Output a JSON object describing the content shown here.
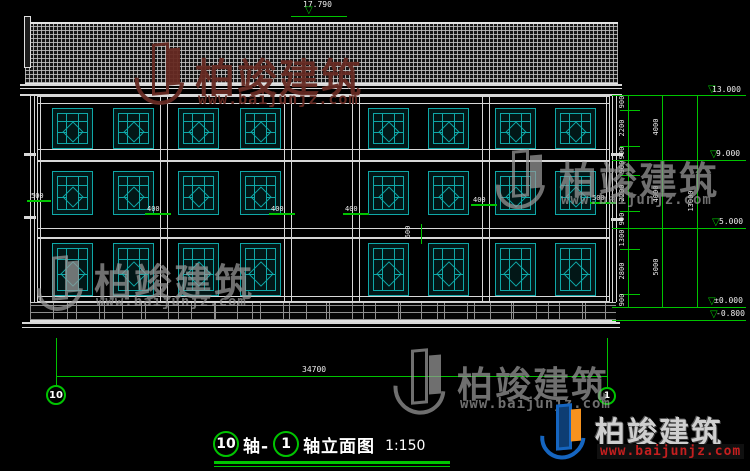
{
  "title_block": {
    "axis_left": "10",
    "joiner": "轴-",
    "axis_right": "1",
    "name_suffix": "轴立面图",
    "scale": "1:150"
  },
  "axis_bubbles": {
    "left": "10",
    "right": "1"
  },
  "elevation_marks": {
    "roof_top": "17.790",
    "levels": [
      "13.000",
      "9.000",
      "5.000",
      "±0.000",
      "-0.800"
    ]
  },
  "dimensions": {
    "right_chain_segments": [
      "900",
      "2200",
      "900",
      "900",
      "2200",
      "900",
      "1300",
      "2800",
      "900"
    ],
    "right_chain_totals": [
      "4000",
      "4000",
      "5000"
    ],
    "right_overall": "13000",
    "bottom_overall": "34700",
    "inline": {
      "left_eave": "500",
      "right_eave": "500",
      "col1": "400",
      "col2": "400",
      "col3": "400",
      "col4": "400",
      "floor_band": "600"
    }
  },
  "watermark": {
    "brand": "柏竣建筑",
    "url": "www.baijunjz.com"
  },
  "colors": {
    "dim_green": "#00c400",
    "window_teal": "#0fa7a7",
    "line_white": "#d8d8d8",
    "wm_top_red": "#662a22",
    "wm_gray": "#9a9a9a",
    "logo_blue": "#1565c0",
    "logo_orange": "#f6921e",
    "url_red": "#c41f1f"
  }
}
